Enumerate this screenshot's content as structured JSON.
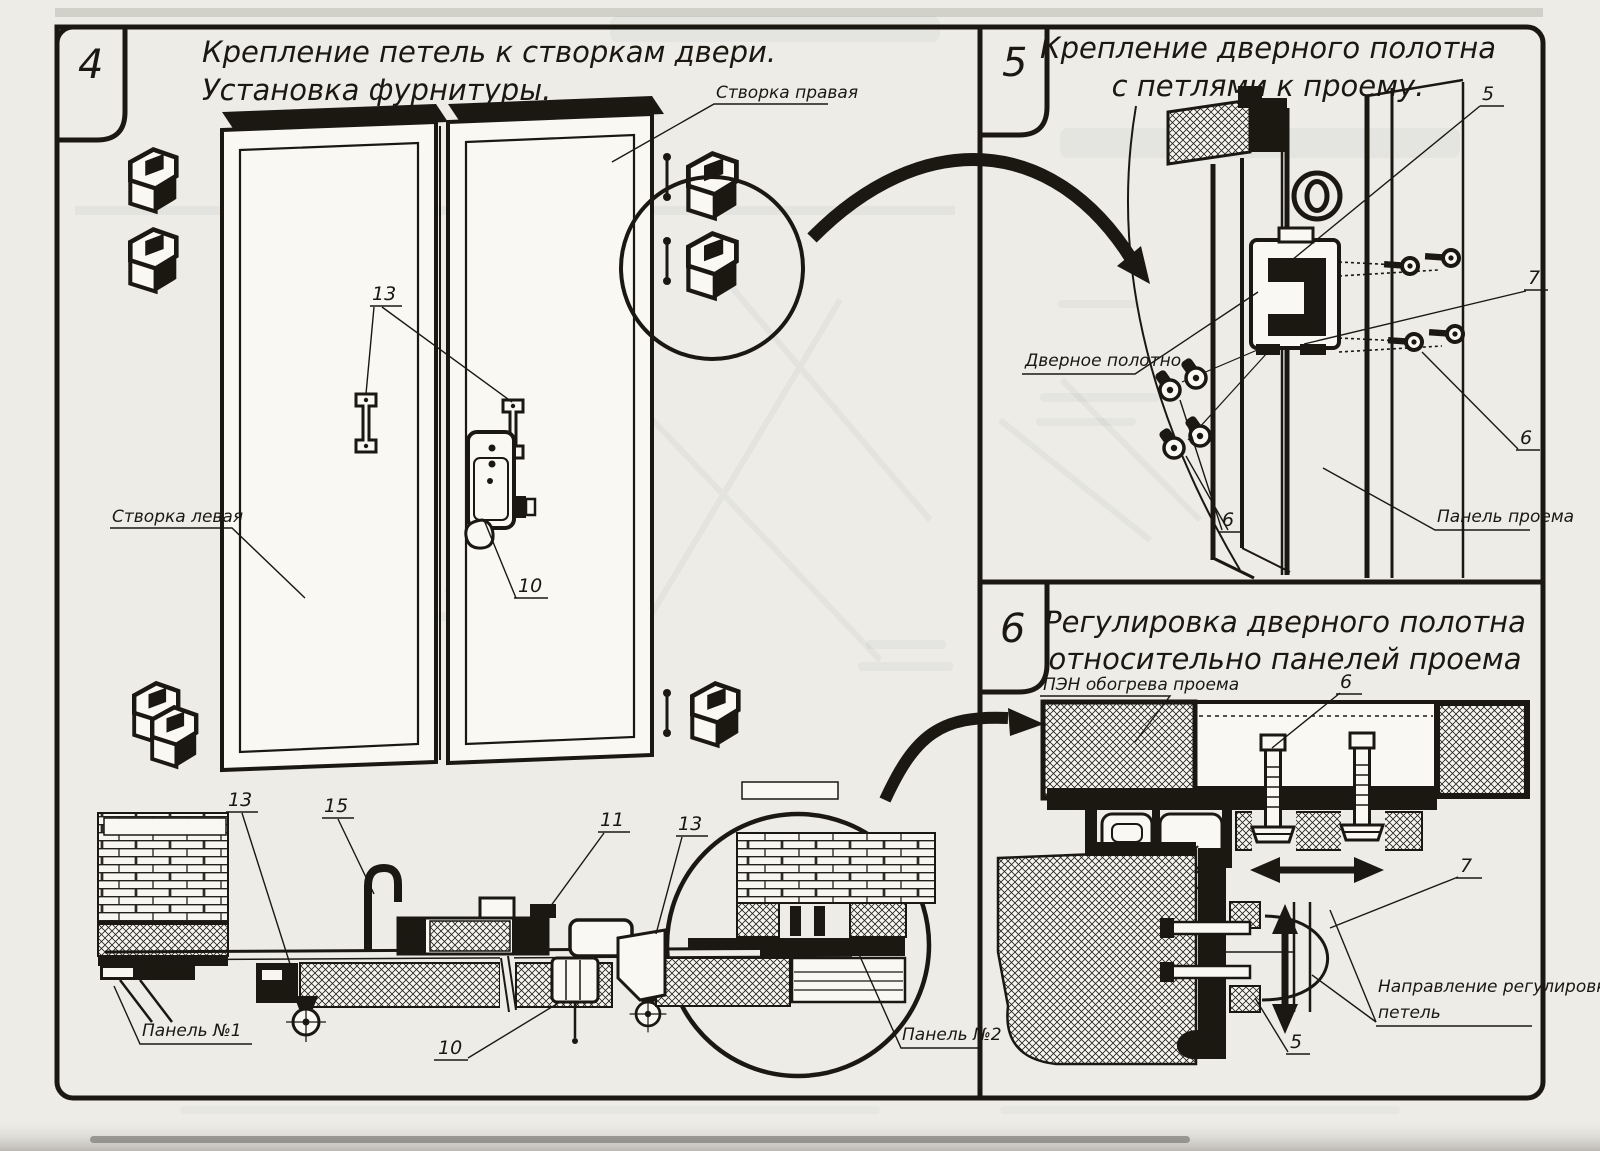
{
  "panel4": {
    "number": "4",
    "title1": "Крепление петель к створкам двери.",
    "title2": "Установка фурнитуры.",
    "label_right_leaf": "Створка правая",
    "label_left_leaf": "Створка левая",
    "label_panel1": "Панель №1",
    "label_panel2": "Панель №2",
    "callout_10": "10",
    "callout_11": "11",
    "callout_13": "13",
    "callout_15": "15"
  },
  "panel5": {
    "number": "5",
    "title1": "Крепление дверного полотна",
    "title2": "с петлями к проему.",
    "label_door_leaf": "Дверное полотно",
    "label_opening_panel": "Панель проема",
    "callout_5": "5",
    "callout_6": "6",
    "callout_7": "7"
  },
  "panel6": {
    "number": "6",
    "title1": "Регулировка дверного полотна",
    "title2": "относительно панелей проема",
    "label_heater": "ПЭН обогрева проема",
    "label_direction1": "Направление регулировки",
    "label_direction2": "петель",
    "callout_5": "5",
    "callout_6": "6",
    "callout_7": "7"
  },
  "colors": {
    "ink": "#1b1812",
    "paper": "#edece6"
  }
}
